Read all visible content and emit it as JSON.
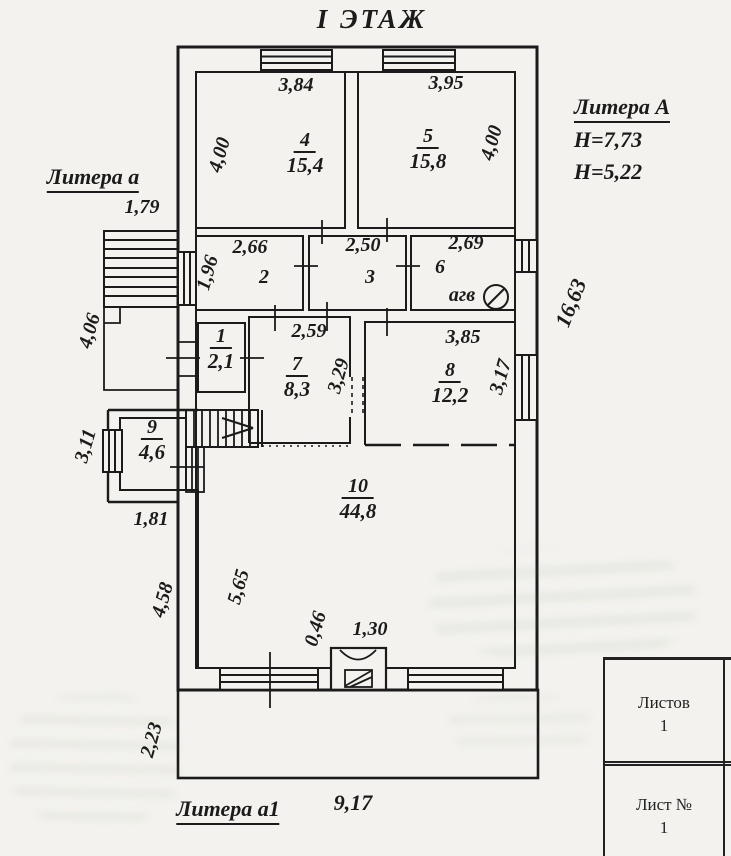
{
  "title": "I ЭТАЖ",
  "annotations": {
    "litera_main": "Литера А",
    "litera_main_h1": "Н=7,73",
    "litera_main_h2": "Н=5,22",
    "litera_porch": "Литера а",
    "litera_veranda": "Литера а1",
    "agv_label": "агв"
  },
  "rooms": {
    "r1": {
      "number": "1",
      "area": "2,1"
    },
    "r2": {
      "number": "2"
    },
    "r3": {
      "number": "3"
    },
    "r4": {
      "number": "4",
      "area": "15,4"
    },
    "r5": {
      "number": "5",
      "area": "15,8"
    },
    "r6": {
      "number": "6"
    },
    "r7": {
      "number": "7",
      "area": "8,3"
    },
    "r8": {
      "number": "8",
      "area": "12,2"
    },
    "r9": {
      "number": "9",
      "area": "4,6"
    },
    "r10": {
      "number": "10",
      "area": "44,8"
    }
  },
  "dimensions": {
    "d_3_84": "3,84",
    "d_3_95": "3,95",
    "d_4_00_left": "4,00",
    "d_4_00_right": "4,00",
    "d_2_66": "2,66",
    "d_2_50": "2,50",
    "d_2_69": "2,69",
    "d_1_96": "1,96",
    "d_2_59": "2,59",
    "d_3_29": "3,29",
    "d_3_85": "3,85",
    "d_3_17": "3,17",
    "d_1_79": "1,79",
    "d_4_06": "4,06",
    "d_3_11": "3,11",
    "d_1_81": "1,81",
    "d_4_58": "4,58",
    "d_5_65": "5,65",
    "d_2_23": "2,23",
    "d_0_46": "0,46",
    "d_1_30": "1,30",
    "d_9_17": "9,17",
    "d_16_63": "16,63"
  },
  "title_block": {
    "rows": [
      {
        "label": "Листов",
        "value": "1"
      },
      {
        "label": "Лист №",
        "value": "1"
      }
    ]
  }
}
